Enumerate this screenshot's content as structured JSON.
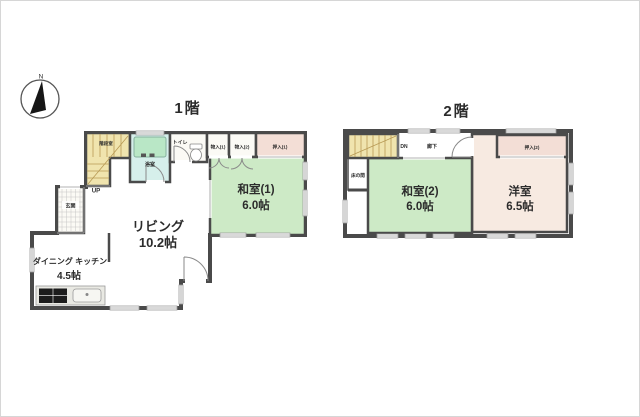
{
  "compass": {
    "north_label": "N"
  },
  "floor1": {
    "title": "1階",
    "stairs_label": "階段室",
    "up_label": "UP",
    "rooms": {
      "living": {
        "name": "リビング",
        "size": "10.2帖"
      },
      "japanese_room_1": {
        "name": "和室(1)",
        "size": "6.0帖"
      },
      "dining_kitchen": {
        "name": "ダイニング キッチン",
        "size": "4.5帖"
      },
      "entrance": {
        "name": "玄関"
      },
      "bathroom": {
        "name": "浴室"
      },
      "toilet": {
        "name": "トイレ"
      },
      "storage_1": {
        "name": "物入(1)"
      },
      "storage_2": {
        "name": "物入(2)"
      },
      "closet_1": {
        "name": "押入(1)"
      }
    }
  },
  "floor2": {
    "title": "2階",
    "down_label": "DN",
    "rooms": {
      "japanese_room_2": {
        "name": "和室(2)",
        "size": "6.0帖"
      },
      "western_room": {
        "name": "洋室",
        "size": "6.5帖"
      },
      "closet_2": {
        "name": "押入(2)"
      },
      "hallway": {
        "name": "廊下"
      },
      "tokonoma": {
        "name": "床の間"
      }
    }
  },
  "colors": {
    "wall": "#4a4a4a",
    "floor_cream": "#f4ead9",
    "tatami_green": "#cdeac6",
    "stairs_yellow": "#f0e4ae",
    "bathroom_cyan": "#d6efeb",
    "bathtub_green": "#b9e7c6",
    "closet_pink": "#f3ded6",
    "western_floor": "#f7eae1",
    "white_room": "#fbfaf5"
  }
}
